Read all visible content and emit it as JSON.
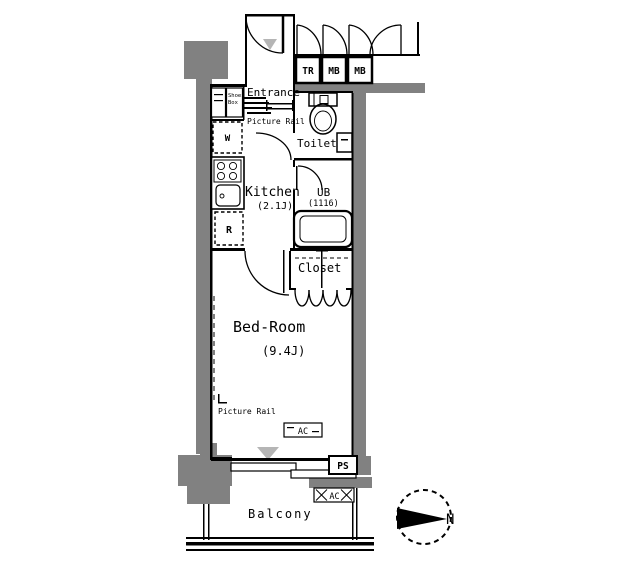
{
  "plan": {
    "corridor_units": {
      "trunk_room": "TR",
      "mailbox_1": "MB",
      "mailbox_2": "MB"
    },
    "rooms": {
      "entrance": {
        "label": "Entrance",
        "shoes_box_line1": "Shoes",
        "shoes_box_line2": "Box",
        "picture_rail": "Picture Rail"
      },
      "toilet": {
        "label": "Toilet"
      },
      "kitchen": {
        "label": "Kitchen",
        "size": "(2.1J)",
        "washer": "W",
        "fridge": "R"
      },
      "bathroom": {
        "label": "UB",
        "size": "(1116)"
      },
      "closet": {
        "label": "Closet"
      },
      "bedroom": {
        "label": "Bed-Room",
        "size": "(9.4J)",
        "picture_rail": "Picture Rail",
        "ac": "AC"
      },
      "balcony": {
        "label": "Balcony",
        "ac": "AC"
      }
    },
    "pipe_space": "PS",
    "compass_north": "N",
    "colors": {
      "wall_gray": "#818181",
      "marker_gray": "#b5b5b5",
      "line": "#000000"
    }
  }
}
